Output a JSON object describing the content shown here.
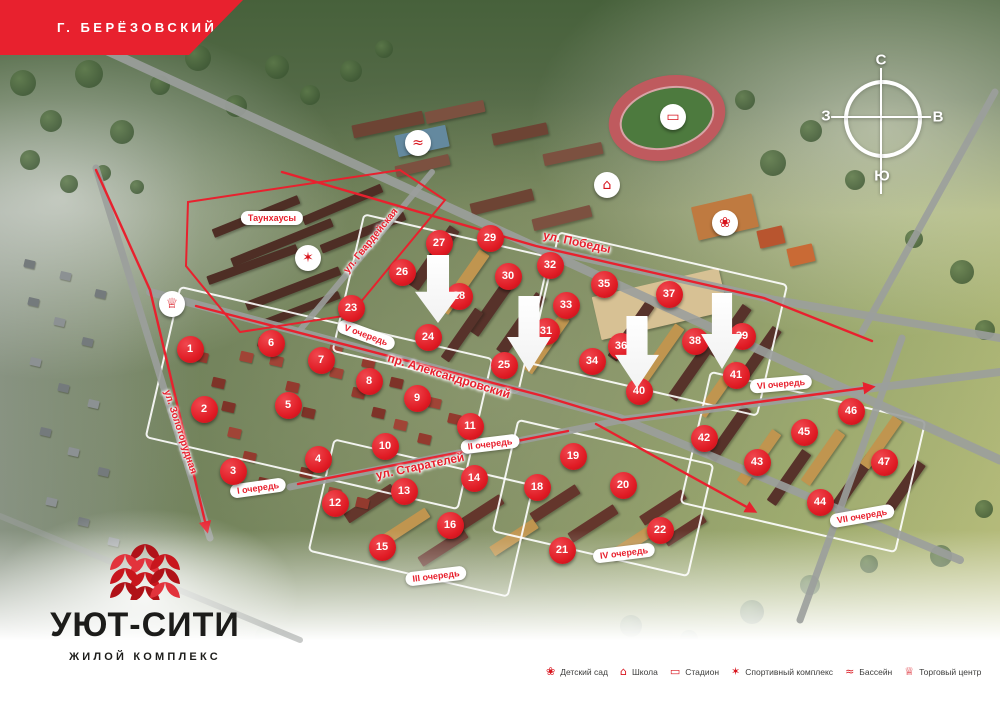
{
  "banner": {
    "city_label": "Г. БЕРЁЗОВСКИЙ"
  },
  "compass": {
    "north": "С",
    "east": "В",
    "south": "Ю",
    "west": "З"
  },
  "logo": {
    "name": "УЮТ-СИТИ",
    "subtitle": "ЖИЛОЙ КОМПЛЕКС"
  },
  "map": {
    "townhouses_label": {
      "text": "Таунхаусы",
      "x": 272,
      "y": 218
    },
    "streets": [
      {
        "id": "pobedy",
        "name": "ул. Победы",
        "x": 577,
        "y": 242,
        "angle": 12,
        "size": 12
      },
      {
        "id": "gvardeyskaya",
        "name": "ул. Гвардейская",
        "x": 371,
        "y": 241,
        "angle": -51,
        "size": 10
      },
      {
        "id": "alexandrovsky",
        "name": "пр. Александровский",
        "x": 449,
        "y": 376,
        "angle": 17,
        "size": 12
      },
      {
        "id": "starateley",
        "name": "ул. Старателей",
        "x": 420,
        "y": 466,
        "angle": -12,
        "size": 12
      },
      {
        "id": "zolotorudnaya",
        "name": "ул. Золоторудная",
        "x": 180,
        "y": 432,
        "angle": 72,
        "size": 10
      }
    ],
    "phases": [
      {
        "label": "I очередь",
        "x": 258,
        "y": 488,
        "angle": -8
      },
      {
        "label": "II очередь",
        "x": 490,
        "y": 444,
        "angle": -7
      },
      {
        "label": "III очередь",
        "x": 436,
        "y": 576,
        "angle": -7
      },
      {
        "label": "IV очередь",
        "x": 624,
        "y": 553,
        "angle": -7
      },
      {
        "label": "V очередь",
        "x": 366,
        "y": 335,
        "angle": 20
      },
      {
        "label": "VI очередь",
        "x": 781,
        "y": 384,
        "angle": -5
      },
      {
        "label": "VII очередь",
        "x": 862,
        "y": 516,
        "angle": -10
      }
    ],
    "markers": [
      {
        "n": 1,
        "x": 190,
        "y": 349
      },
      {
        "n": 2,
        "x": 204,
        "y": 409
      },
      {
        "n": 3,
        "x": 233,
        "y": 471
      },
      {
        "n": 4,
        "x": 318,
        "y": 459
      },
      {
        "n": 5,
        "x": 288,
        "y": 405
      },
      {
        "n": 6,
        "x": 271,
        "y": 343
      },
      {
        "n": 7,
        "x": 321,
        "y": 360
      },
      {
        "n": 8,
        "x": 369,
        "y": 381
      },
      {
        "n": 9,
        "x": 417,
        "y": 398
      },
      {
        "n": 10,
        "x": 385,
        "y": 446
      },
      {
        "n": 11,
        "x": 470,
        "y": 426
      },
      {
        "n": 12,
        "x": 335,
        "y": 503
      },
      {
        "n": 13,
        "x": 404,
        "y": 491
      },
      {
        "n": 14,
        "x": 474,
        "y": 478
      },
      {
        "n": 15,
        "x": 382,
        "y": 547
      },
      {
        "n": 16,
        "x": 450,
        "y": 525
      },
      {
        "n": 18,
        "x": 537,
        "y": 487
      },
      {
        "n": 19,
        "x": 573,
        "y": 456
      },
      {
        "n": 20,
        "x": 623,
        "y": 485
      },
      {
        "n": 21,
        "x": 562,
        "y": 550
      },
      {
        "n": 22,
        "x": 660,
        "y": 530
      },
      {
        "n": 23,
        "x": 351,
        "y": 308
      },
      {
        "n": 24,
        "x": 428,
        "y": 337
      },
      {
        "n": 25,
        "x": 504,
        "y": 365
      },
      {
        "n": 26,
        "x": 402,
        "y": 272
      },
      {
        "n": 27,
        "x": 439,
        "y": 243
      },
      {
        "n": 28,
        "x": 459,
        "y": 296,
        "under": true
      },
      {
        "n": 29,
        "x": 490,
        "y": 238
      },
      {
        "n": 30,
        "x": 508,
        "y": 276
      },
      {
        "n": 31,
        "x": 546,
        "y": 331,
        "under": true
      },
      {
        "n": 32,
        "x": 550,
        "y": 265
      },
      {
        "n": 33,
        "x": 566,
        "y": 305
      },
      {
        "n": 34,
        "x": 592,
        "y": 361
      },
      {
        "n": 35,
        "x": 604,
        "y": 284
      },
      {
        "n": 36,
        "x": 621,
        "y": 346,
        "under": true
      },
      {
        "n": 37,
        "x": 669,
        "y": 294
      },
      {
        "n": 38,
        "x": 695,
        "y": 341
      },
      {
        "n": 39,
        "x": 742,
        "y": 336,
        "under": true
      },
      {
        "n": 40,
        "x": 639,
        "y": 391
      },
      {
        "n": 41,
        "x": 736,
        "y": 375
      },
      {
        "n": 42,
        "x": 704,
        "y": 438
      },
      {
        "n": 43,
        "x": 757,
        "y": 462
      },
      {
        "n": 44,
        "x": 820,
        "y": 502
      },
      {
        "n": 45,
        "x": 804,
        "y": 432
      },
      {
        "n": 46,
        "x": 851,
        "y": 411
      },
      {
        "n": 47,
        "x": 884,
        "y": 462
      }
    ],
    "pois": [
      {
        "id": "pool",
        "label": "Бассейн",
        "x": 418,
        "y": 143
      },
      {
        "id": "school",
        "label": "Школа",
        "x": 607,
        "y": 185
      },
      {
        "id": "stadium",
        "label": "Стадион",
        "x": 673,
        "y": 117
      },
      {
        "id": "kindergarten",
        "label": "Детский сад",
        "x": 725,
        "y": 223
      },
      {
        "id": "sport",
        "label": "Спортивный комплекс",
        "x": 308,
        "y": 258
      },
      {
        "id": "mall",
        "label": "Торговый центр",
        "x": 172,
        "y": 304
      }
    ],
    "arrows": [
      {
        "x": 415,
        "y": 255,
        "w": 46,
        "h": 68
      },
      {
        "x": 507,
        "y": 296,
        "w": 44,
        "h": 76
      },
      {
        "x": 615,
        "y": 316,
        "w": 44,
        "h": 72
      },
      {
        "x": 701,
        "y": 293,
        "w": 42,
        "h": 76
      }
    ]
  },
  "legend": {
    "items": [
      {
        "id": "kindergarten",
        "label": "Детский сад"
      },
      {
        "id": "school",
        "label": "Школа"
      },
      {
        "id": "stadium",
        "label": "Стадион"
      },
      {
        "id": "sport",
        "label": "Спортивный комплекс"
      },
      {
        "id": "pool",
        "label": "Бассейн"
      },
      {
        "id": "mall",
        "label": "Торговый центр"
      }
    ]
  },
  "colors": {
    "brand_red": "#e8212e",
    "marker_red": "#e01b24",
    "logo_dark": "#1c1c1a"
  }
}
